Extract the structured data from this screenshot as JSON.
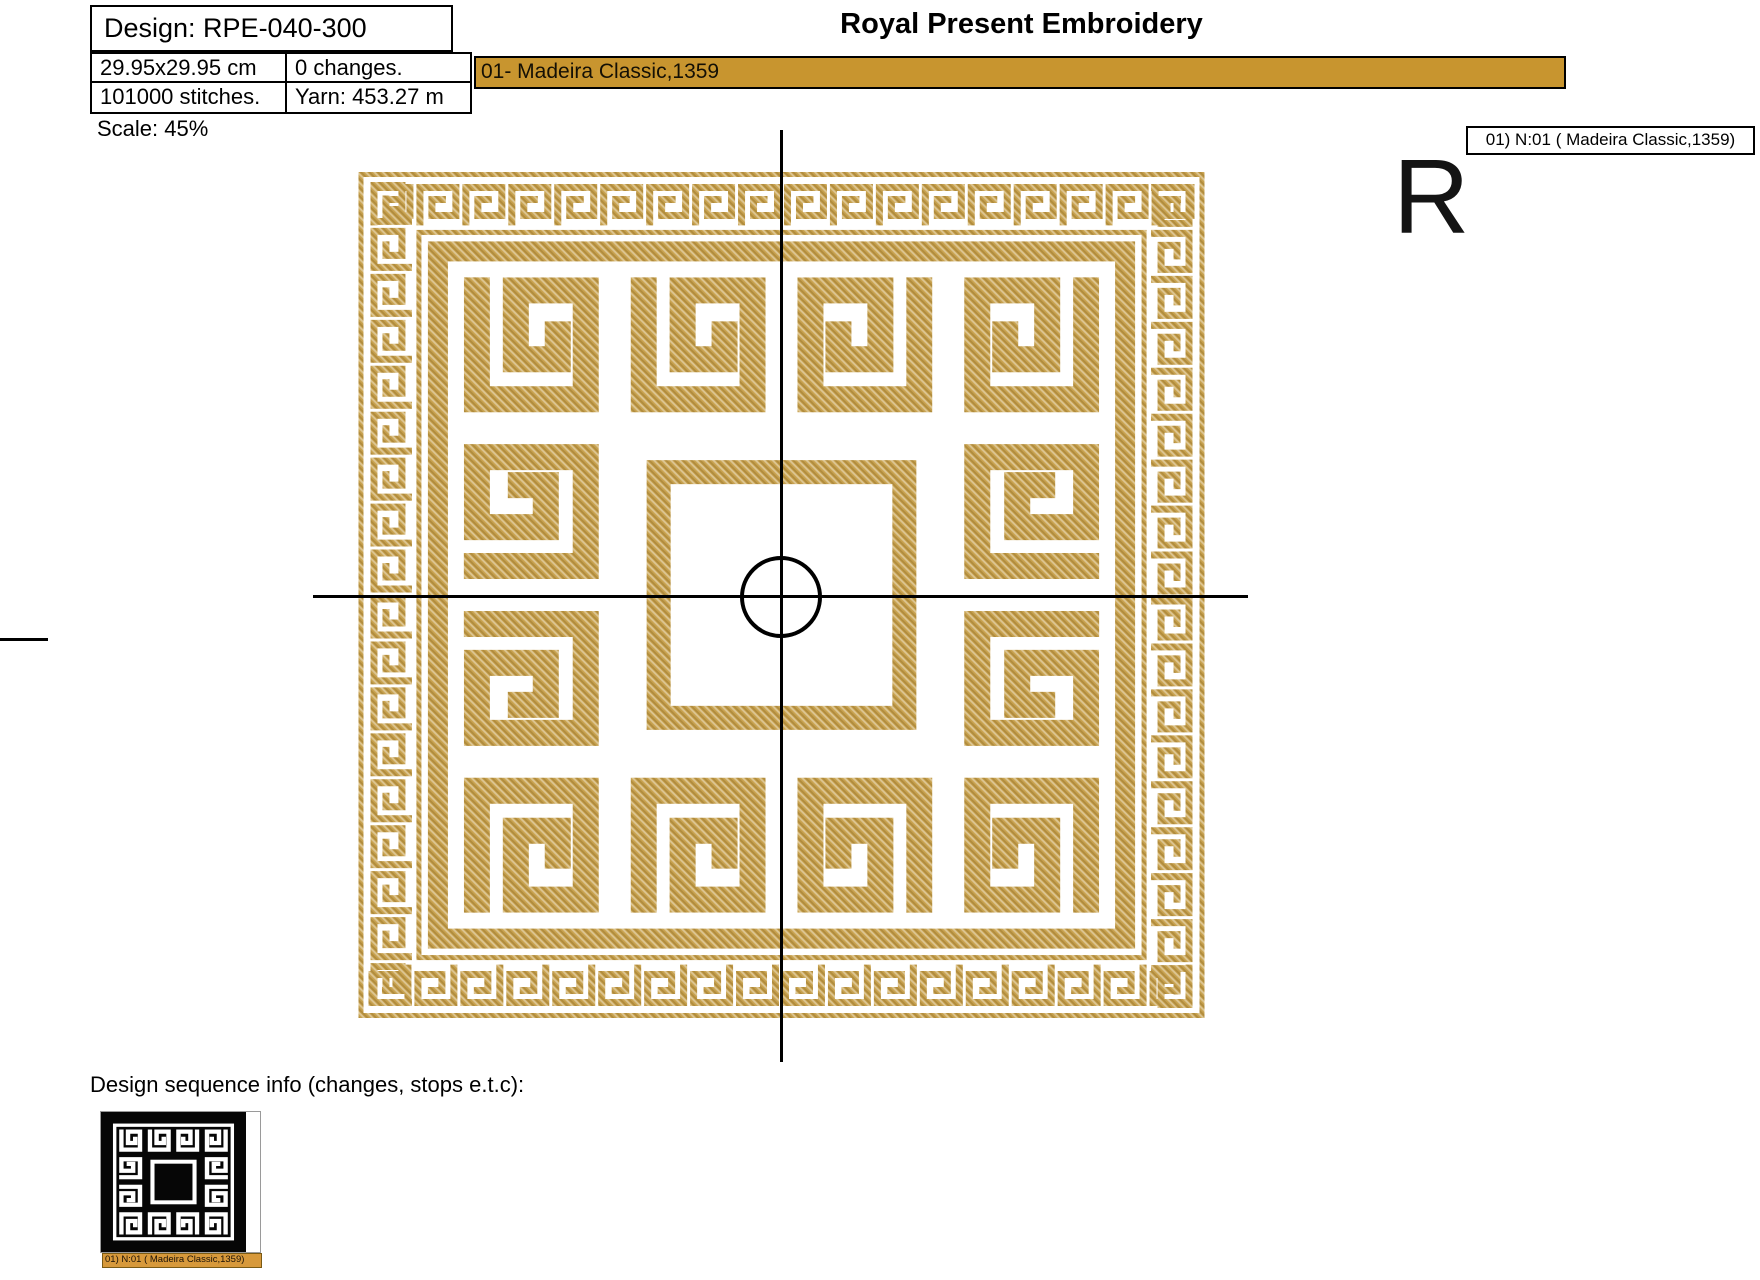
{
  "header": {
    "design_title": "Design: RPE-040-300",
    "brand": "Royal Present Embroidery",
    "stats": {
      "size": "29.95x29.95 cm",
      "changes": "0 changes.",
      "stitches": "101000 stitches.",
      "yarn": "Yarn: 453.27 m"
    },
    "thread_bar_label": "01- Madeira Classic,1359",
    "scale_label": "Scale: 45%",
    "thread_tag": "01) N:01 ( Madeira Classic,1359)",
    "watermark_letter": "R"
  },
  "footer": {
    "sequence_heading": "Design sequence info (changes, stops e.t.c):",
    "thumbnail_caption": "01) N:01 ( Madeira Classic,1359)"
  },
  "colors": {
    "thread_gold": "#C7A14E",
    "bar_gold": "#C8952F",
    "caption_gold": "#D7993B",
    "ink": "#000000"
  }
}
